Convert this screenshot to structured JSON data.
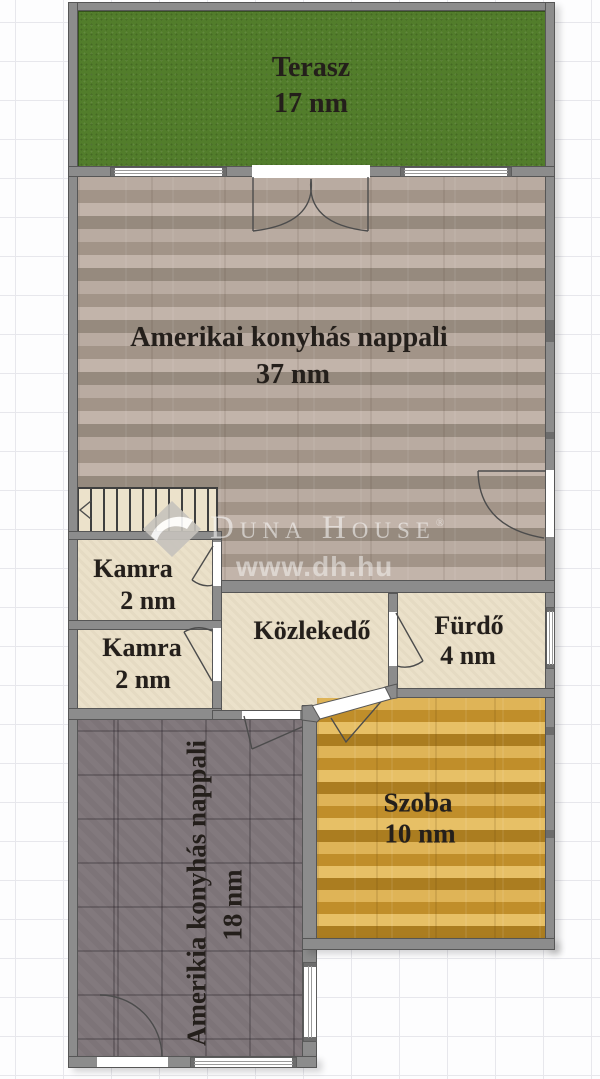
{
  "plan": {
    "watermark": {
      "brand": "Duna House",
      "registered": "®",
      "website": "www.dh.hu"
    },
    "rooms": {
      "terasz": {
        "name": "Terasz",
        "area": "17 nm"
      },
      "nappali": {
        "name": "Amerikai konyhás nappali",
        "area": "37 nm"
      },
      "kamra1": {
        "name": "Kamra",
        "area": "2 nm"
      },
      "kamra2": {
        "name": "Kamra",
        "area": "2 nm"
      },
      "kozlekedo": {
        "name": "Közlekedő"
      },
      "furdo": {
        "name": "Fürdő",
        "area": "4 nm"
      },
      "szoba": {
        "name": "Szoba",
        "area": "10 nm"
      },
      "konyhas_nappali_also": {
        "name": "Amerikia konyhás nappali",
        "area": "18 nm"
      }
    },
    "colors": {
      "terrace_green": "#527d2b",
      "living_wood": "#a99b91",
      "room_wood": "#cf9e3d",
      "tile_dark": "#7d7478",
      "floor_cream": "#ebe1ca",
      "wall_gray": "#8c8c8c"
    }
  }
}
